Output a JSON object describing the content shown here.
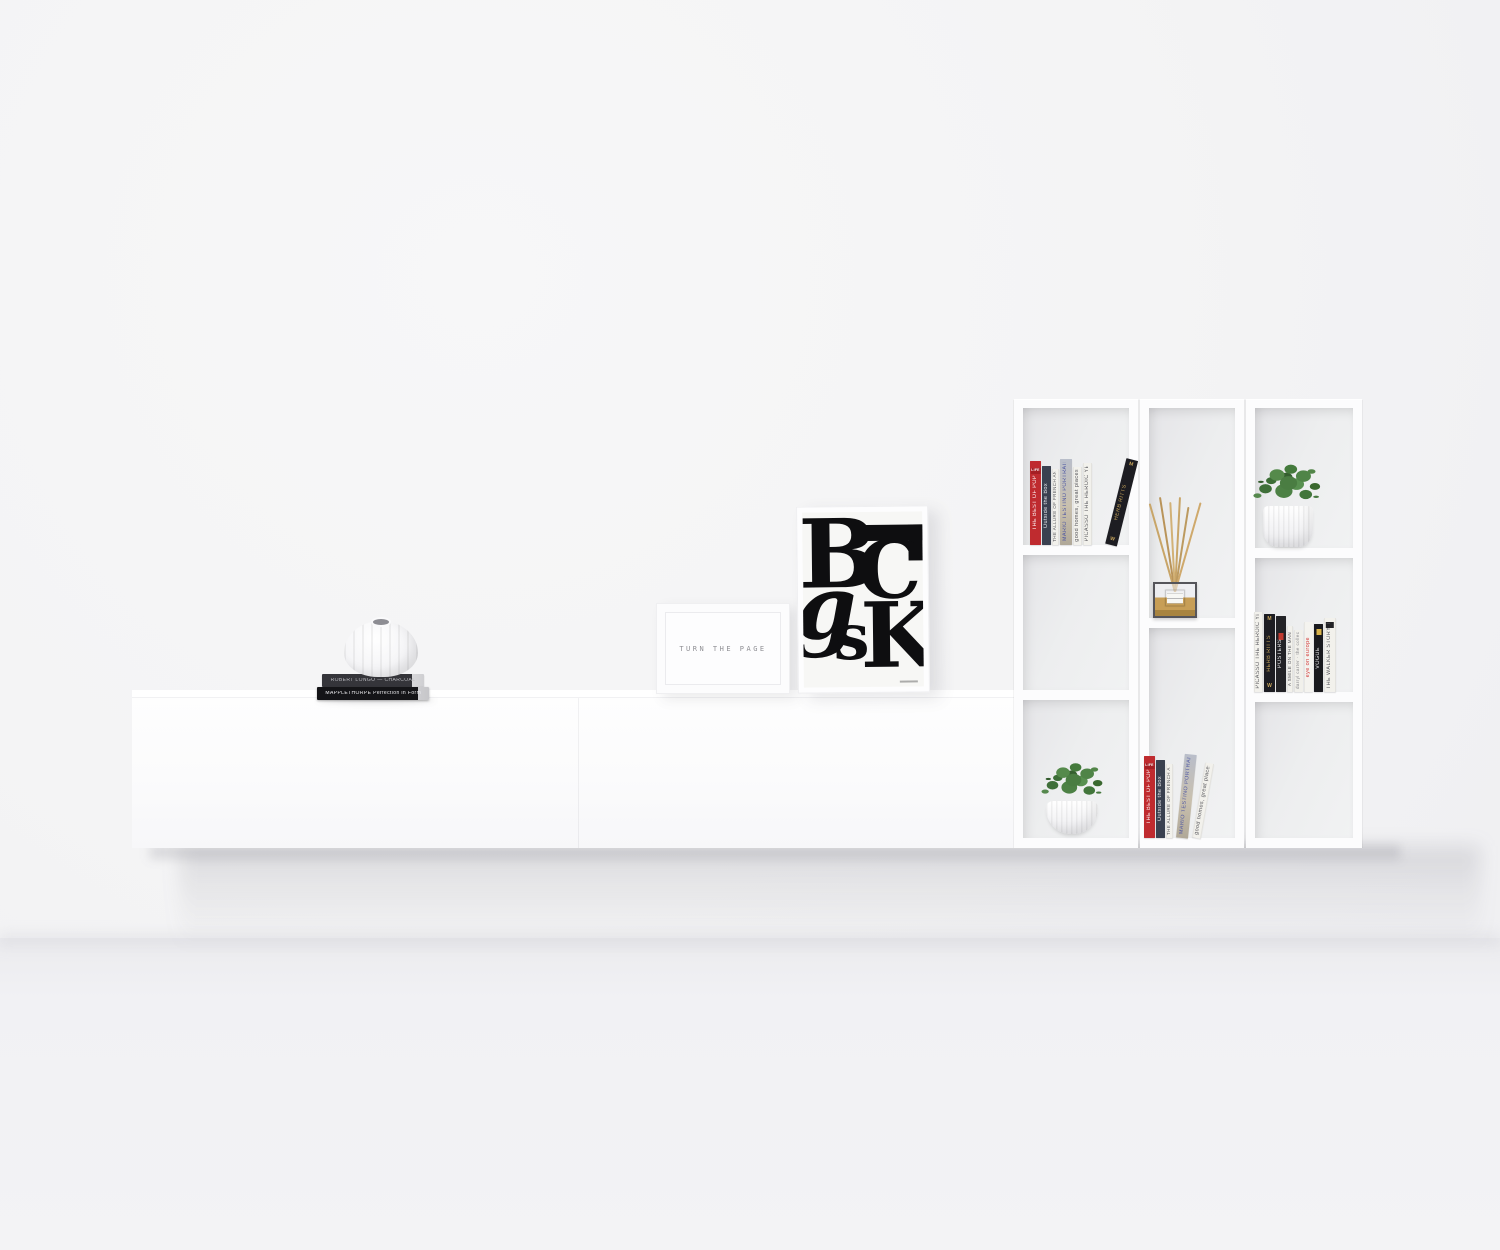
{
  "scene": {
    "description": "Minimalist white interior render: wall-mounted floating sideboard with decor and a three-column wall shelf unit",
    "palette": {
      "wall": "#f4f4f5",
      "floor": "#f1f1f4",
      "furniture_white": "#fcfcfd",
      "shadow": "#dededf",
      "book_red": "#bf2b2f",
      "book_black": "#1d1d22",
      "gold_text": "#c9a65c",
      "accent_red_text": "#d23a39",
      "plant_green": "#4a7d42",
      "reed_amber": "#c79e56"
    }
  },
  "sideboard": {
    "stack_books": [
      {
        "title": "ROBERT LONGO — CHARCOAL"
      },
      {
        "title": "MAPPLETHORPE  Perfection in Form"
      }
    ]
  },
  "wall_frame": {
    "text": "TURN THE PAGE"
  },
  "poster": {
    "letters": {
      "b": "B",
      "c": "C",
      "g": "g",
      "s": "s",
      "k": "K"
    }
  },
  "shelf": {
    "left_top_books": [
      {
        "title": "THE BEST OF POP",
        "badge": "LIFE"
      },
      {
        "title": "Outside the Box"
      },
      {
        "title": "THE ALLURE OF FRENCH AND ITALIAN DECOR"
      },
      {
        "title": "MARIO TESTINO PORTRAITS"
      },
      {
        "title": "good homes, great places"
      },
      {
        "title": "PICASSO THE HEROIC YEARS"
      },
      {
        "title": "HERB RITTS",
        "badge_top": "M",
        "badge_bottom": "W"
      }
    ],
    "middle_bottom_books": [
      {
        "title": "THE BEST OF POP",
        "badge": "LIFE"
      },
      {
        "title": "Outside the Box"
      },
      {
        "title": "THE ALLURE OF FRENCH AND ITALIAN DECOR"
      },
      {
        "title": "MARIO TESTINO PORTRAITS"
      },
      {
        "title": "good homes, great places"
      }
    ],
    "right_middle_books": [
      {
        "title": "PICASSO THE HEROIC YEARS"
      },
      {
        "title": "HERB RITTS",
        "badge_top": "M",
        "badge_bottom": "W"
      },
      {
        "title": "POSTERS"
      },
      {
        "title": "A SMILE ON THE MAN"
      },
      {
        "title": "darryl carter · the collected home"
      },
      {
        "title": "eye on europe"
      },
      {
        "title": "VOGUE"
      },
      {
        "title": "THE WALKER STORY THEATER"
      }
    ]
  }
}
